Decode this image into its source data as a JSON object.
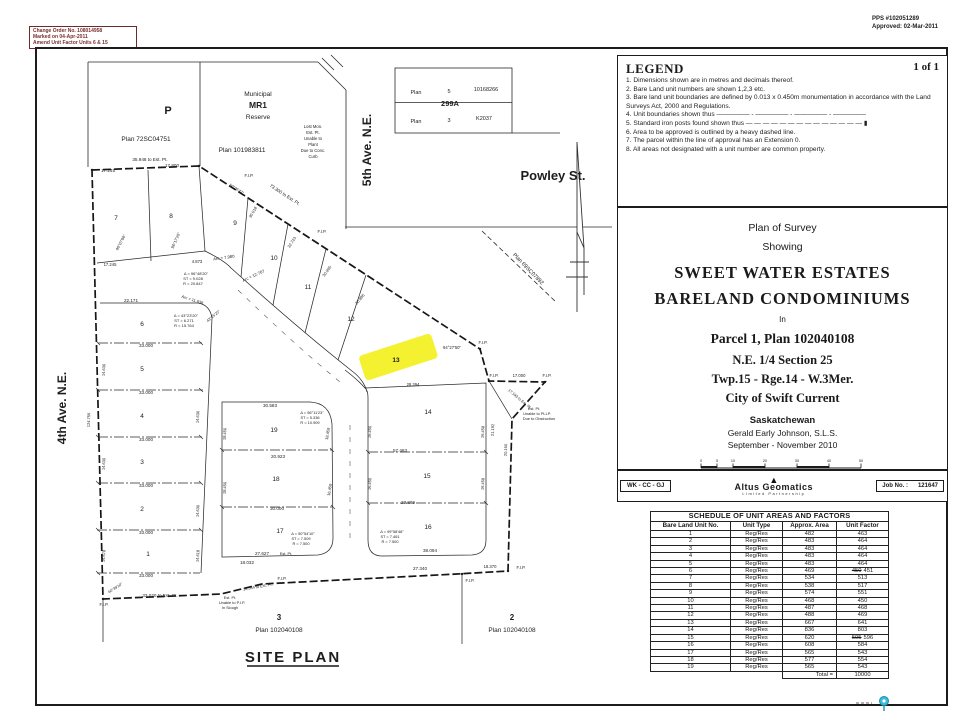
{
  "stamps": {
    "change_order": [
      "Change Order No. 108014958",
      "Marked on 04-Apr-2011",
      "Amend Unit Factor Units 6 & 15"
    ],
    "pps": "PPS #102051289",
    "approved": "Approved: 02-Mar-2011"
  },
  "legend": {
    "title": "LEGEND",
    "page": "1 of 1",
    "items": [
      "1. Dimensions shown are in metres and decimals thereof.",
      "2. Bare Land unit numbers are shown 1,2,3 etc.",
      "3. Bare land unit boundaries are defined by 0.013 x 0.450m monumentation in accordance with the Land Surveys Act, 2000 and Regulations.",
      "4. Unit boundaries shown thus ————— - ————— - ————— - —————",
      "5. Standard iron posts found shown thus — — — — — — — — — — — — — — ▮",
      "6. Area to be approved is outlined by a heavy dashed line.",
      "7. The parcel within the line of approval has an Extension 0.",
      "8. All areas not designated with a unit number are common property."
    ]
  },
  "title_block": {
    "line1": "Plan of Survey",
    "line2": "Showing",
    "name1": "SWEET WATER ESTATES",
    "name2": "BARELAND CONDOMINIUMS",
    "in_label": "In",
    "parcel": "Parcel 1, Plan 102040108",
    "quarter": "N.E. 1/4 Section 25",
    "township": "Twp.15 - Rge.14 - W.3Mer.",
    "city": "City of Swift Current",
    "province": "Saskatchewan",
    "surveyor": "Gerald Early Johnson, S.L.S.",
    "date_range": "September - November 2010",
    "scale_ticks": [
      "0",
      "5",
      "10",
      "20",
      "30",
      "40",
      "50"
    ],
    "scale_units": "metres",
    "scale_text": "Scale - 1 : 500",
    "crew": "WK - CC - GJ",
    "firm_name": "Altus Geomatics",
    "firm_sub": "Limited Partnership",
    "job_label": "Job No. :",
    "job_value": "121647"
  },
  "schedule": {
    "title": "SCHEDULE OF UNIT AREAS AND FACTORS",
    "columns": [
      "Bare Land Unit No.",
      "Unit Type",
      "Approx. Area",
      "Unit Factor"
    ],
    "rows": [
      [
        "1",
        "Reg/Res",
        "482",
        "463"
      ],
      [
        "2",
        "Reg/Res",
        "483",
        "464"
      ],
      [
        "3",
        "Reg/Res",
        "483",
        "464"
      ],
      [
        "4",
        "Reg/Res",
        "483",
        "464"
      ],
      [
        "5",
        "Reg/Res",
        "483",
        "464"
      ],
      [
        "6",
        "Reg/Res",
        "469",
        "450",
        "451"
      ],
      [
        "7",
        "Reg/Res",
        "534",
        "513"
      ],
      [
        "8",
        "Reg/Res",
        "538",
        "517"
      ],
      [
        "9",
        "Reg/Res",
        "574",
        "551"
      ],
      [
        "10",
        "Reg/Res",
        "468",
        "450"
      ],
      [
        "11",
        "Reg/Res",
        "487",
        "468"
      ],
      [
        "12",
        "Reg/Res",
        "488",
        "469"
      ],
      [
        "13",
        "Reg/Res",
        "667",
        "641"
      ],
      [
        "14",
        "Reg/Res",
        "836",
        "803"
      ],
      [
        "15",
        "Reg/Res",
        "620",
        "595",
        "596"
      ],
      [
        "16",
        "Reg/Res",
        "608",
        "584"
      ],
      [
        "17",
        "Reg/Res",
        "565",
        "543"
      ],
      [
        "18",
        "Reg/Res",
        "577",
        "554"
      ],
      [
        "19",
        "Reg/Res",
        "565",
        "543"
      ]
    ],
    "total_label": "Total =",
    "total_value": "10000"
  },
  "site_plan": {
    "title": "SITE PLAN",
    "highlight_color": "#f2ee0c",
    "lots": [
      {
        "t": "1",
        "x": 148,
        "y": 556
      },
      {
        "t": "2",
        "x": 142,
        "y": 511
      },
      {
        "t": "3",
        "x": 142,
        "y": 464
      },
      {
        "t": "4",
        "x": 142,
        "y": 418
      },
      {
        "t": "5",
        "x": 142,
        "y": 371
      },
      {
        "t": "6",
        "x": 142,
        "y": 326
      },
      {
        "t": "7",
        "x": 116,
        "y": 220
      },
      {
        "t": "8",
        "x": 171,
        "y": 218
      },
      {
        "t": "9",
        "x": 235,
        "y": 225
      },
      {
        "t": "10",
        "x": 274,
        "y": 260
      },
      {
        "t": "11",
        "x": 308,
        "y": 289
      },
      {
        "t": "12",
        "x": 351,
        "y": 321
      },
      {
        "t": "13",
        "x": 396,
        "y": 362,
        "b": 1
      },
      {
        "t": "14",
        "x": 428,
        "y": 414
      },
      {
        "t": "15",
        "x": 427,
        "y": 478
      },
      {
        "t": "16",
        "x": 428,
        "y": 529
      },
      {
        "t": "17",
        "x": 280,
        "y": 533
      },
      {
        "t": "18",
        "x": 276,
        "y": 481
      },
      {
        "t": "19",
        "x": 274,
        "y": 432
      }
    ],
    "annotations": [
      {
        "t": "4th Ave. N.E.",
        "x": 66,
        "y": 408,
        "r": -90,
        "s": 12,
        "b": 1,
        "f": 1,
        "n": "street-label-4th-ave"
      },
      {
        "t": "5th Ave. N.E.",
        "x": 371,
        "y": 150,
        "r": -90,
        "s": 12,
        "b": 1,
        "f": 1,
        "n": "street-label-5th-ave"
      },
      {
        "t": "Powley St.",
        "x": 553,
        "y": 180,
        "s": 13,
        "b": 1,
        "f": 1,
        "n": "street-label-powley"
      },
      {
        "t": "P",
        "x": 168,
        "y": 114,
        "s": 11,
        "b": 1,
        "f": 1,
        "n": "parcel-label-p"
      },
      {
        "t": "Plan 72SC04751",
        "x": 146,
        "y": 141,
        "s": 6.5,
        "n": "parcel-plan-number"
      },
      {
        "t": "Municipal",
        "x": 258,
        "y": 96,
        "s": 6.5,
        "n": "reserve-label"
      },
      {
        "t": "MR1",
        "x": 258,
        "y": 108,
        "s": 8.5,
        "b": 1,
        "n": "reserve-label"
      },
      {
        "t": "Reserve",
        "x": 258,
        "y": 119,
        "s": 6.5,
        "n": "reserve-label"
      },
      {
        "t": "Plan 101983811",
        "x": 242,
        "y": 152,
        "s": 6.5,
        "n": "parcel-plan-number"
      },
      {
        "t": "Plan 69SC07892",
        "x": 527,
        "y": 270,
        "r": 46,
        "s": 5.5,
        "n": "parcel-plan-number"
      },
      {
        "t": "Plan",
        "x": 416,
        "y": 94,
        "s": 5.5
      },
      {
        "t": "5",
        "x": 449,
        "y": 93,
        "s": 5.5
      },
      {
        "t": "10168266",
        "x": 486,
        "y": 91,
        "s": 5.5
      },
      {
        "t": "299A",
        "x": 450,
        "y": 106,
        "s": 7.5,
        "b": 1,
        "n": "plan-299a-label"
      },
      {
        "t": "Plan",
        "x": 416,
        "y": 123,
        "s": 5.5
      },
      {
        "t": "3",
        "x": 449,
        "y": 122,
        "s": 5.5
      },
      {
        "t": "K2037",
        "x": 484,
        "y": 120,
        "s": 5.5
      },
      {
        "t": "3",
        "x": 279,
        "y": 620,
        "s": 8,
        "b": 1,
        "n": "south-parcel-3"
      },
      {
        "t": "Plan 102040108",
        "x": 279,
        "y": 632,
        "s": 6.5,
        "n": "parcel-plan-number"
      },
      {
        "t": "2",
        "x": 512,
        "y": 620,
        "s": 8,
        "b": 1,
        "n": "south-parcel-2"
      },
      {
        "t": "Plan 102040108",
        "x": 512,
        "y": 632,
        "s": 6.5,
        "n": "parcel-plan-number"
      },
      {
        "t": "35.948 to Est. Pt.",
        "x": 150,
        "y": 161
      },
      {
        "t": "17.245",
        "x": 108,
        "y": 172
      },
      {
        "t": "17.800",
        "x": 172,
        "y": 167
      },
      {
        "t": "F.I.P.",
        "x": 249,
        "y": 177,
        "s": 4.2
      },
      {
        "t": "73.300 to Est. Pt.",
        "x": 284,
        "y": 196,
        "r": 33
      },
      {
        "t": "Lost Mon.",
        "x": 313,
        "y": 128,
        "s": 4.2
      },
      {
        "t": "Est. Pt.",
        "x": 313,
        "y": 134,
        "s": 4.2
      },
      {
        "t": "Unable to",
        "x": 313,
        "y": 140,
        "s": 4.2
      },
      {
        "t": "Plant",
        "x": 313,
        "y": 146,
        "s": 4.2
      },
      {
        "t": "Due to Conc.",
        "x": 313,
        "y": 152,
        "s": 4.2
      },
      {
        "t": "Curb",
        "x": 313,
        "y": 158,
        "s": 4.2
      },
      {
        "t": "90°07'00\"",
        "x": 122,
        "y": 243,
        "r": -62,
        "s": 4
      },
      {
        "t": "96°17'20\"",
        "x": 177,
        "y": 241,
        "r": -66,
        "s": 4
      },
      {
        "t": "17.245",
        "x": 110,
        "y": 266,
        "s": 4.2
      },
      {
        "t": "4.873",
        "x": 197,
        "y": 263,
        "s": 4.2
      },
      {
        "t": "Arc = 7.980",
        "x": 224,
        "y": 259,
        "r": -8,
        "s": 4.2
      },
      {
        "t": "Arc = 12.767",
        "x": 254,
        "y": 277,
        "r": -25,
        "s": 4.2
      },
      {
        "t": "Δ = 96°48'20\"",
        "x": 196,
        "y": 275,
        "s": 4
      },
      {
        "t": "ST = 9.028",
        "x": 193,
        "y": 280,
        "s": 4
      },
      {
        "t": "R = 20.847",
        "x": 193,
        "y": 285,
        "s": 4
      },
      {
        "t": "50°06'47\"",
        "x": 236,
        "y": 190,
        "r": 33,
        "s": 3.8
      },
      {
        "t": "30.018",
        "x": 254,
        "y": 213,
        "r": -60,
        "s": 4
      },
      {
        "t": "32.723",
        "x": 293,
        "y": 243,
        "r": -57,
        "s": 4
      },
      {
        "t": "30.995",
        "x": 328,
        "y": 272,
        "r": -54,
        "s": 4
      },
      {
        "t": "30.985",
        "x": 361,
        "y": 300,
        "r": -51,
        "s": 4
      },
      {
        "t": "F.I.P.",
        "x": 322,
        "y": 233,
        "s": 4.2
      },
      {
        "t": "F.I.P.",
        "x": 483,
        "y": 344,
        "s": 4.2
      },
      {
        "t": "94°27'50\"",
        "x": 452,
        "y": 349,
        "s": 4.2
      },
      {
        "t": "28.394",
        "x": 413,
        "y": 386,
        "s": 4.2
      },
      {
        "t": "17.000",
        "x": 519,
        "y": 377,
        "s": 4.2
      },
      {
        "t": "F.I.P.",
        "x": 494,
        "y": 377,
        "s": 4.2
      },
      {
        "t": "F.I.P.",
        "x": 547,
        "y": 377,
        "s": 4.2
      },
      {
        "t": "Est. Pt.",
        "x": 534,
        "y": 410,
        "s": 3.9
      },
      {
        "t": "Unable to PLLP.",
        "x": 537,
        "y": 415,
        "s": 3.9
      },
      {
        "t": "Due to Obstruction",
        "x": 539,
        "y": 420,
        "s": 3.9
      },
      {
        "t": "17.193 to Est. Pt.",
        "x": 519,
        "y": 400,
        "r": 40,
        "s": 3.8
      },
      {
        "t": "20.160",
        "x": 507,
        "y": 450,
        "r": -88,
        "s": 4
      },
      {
        "t": "21.192",
        "x": 494,
        "y": 430,
        "r": -88,
        "s": 4
      },
      {
        "t": "22.171",
        "x": 131,
        "y": 302
      },
      {
        "t": "33.000",
        "x": 146,
        "y": 347
      },
      {
        "t": "33.000",
        "x": 146,
        "y": 394
      },
      {
        "t": "33.000",
        "x": 146,
        "y": 441
      },
      {
        "t": "33.000",
        "x": 146,
        "y": 487
      },
      {
        "t": "33.000",
        "x": 146,
        "y": 534
      },
      {
        "t": "33.000",
        "x": 146,
        "y": 577
      },
      {
        "t": "14.630",
        "x": 105,
        "y": 370,
        "r": -86,
        "s": 4
      },
      {
        "t": "14.630",
        "x": 105,
        "y": 464,
        "r": -86,
        "s": 4
      },
      {
        "t": "14.678",
        "x": 105,
        "y": 556,
        "r": -86,
        "s": 4
      },
      {
        "t": "14.630",
        "x": 199,
        "y": 417,
        "r": -86,
        "s": 4
      },
      {
        "t": "14.630",
        "x": 199,
        "y": 511,
        "r": -86,
        "s": 4
      },
      {
        "t": "14.618",
        "x": 199,
        "y": 556,
        "r": -86,
        "s": 4
      },
      {
        "t": "124.756",
        "x": 90,
        "y": 420,
        "r": -88,
        "s": 4
      },
      {
        "t": "Δ = 43°23'20\"",
        "x": 186,
        "y": 317,
        "s": 4
      },
      {
        "t": "ST = 6.271",
        "x": 184,
        "y": 322,
        "s": 4
      },
      {
        "t": "R = 15.764",
        "x": 184,
        "y": 327,
        "s": 4
      },
      {
        "t": "Arc = 11.638",
        "x": 192,
        "y": 301,
        "r": 18,
        "s": 4
      },
      {
        "t": "43°25'20\"",
        "x": 214,
        "y": 317,
        "r": -40,
        "s": 3.8
      },
      {
        "t": "30.583",
        "x": 270,
        "y": 407
      },
      {
        "t": "20.923",
        "x": 278,
        "y": 458
      },
      {
        "t": "30.000",
        "x": 277,
        "y": 510
      },
      {
        "t": "27.627",
        "x": 262,
        "y": 555
      },
      {
        "t": "Est. Pt.",
        "x": 286,
        "y": 555,
        "s": 3.9
      },
      {
        "t": "18.032",
        "x": 247,
        "y": 564
      },
      {
        "t": "18.450",
        "x": 226,
        "y": 434,
        "r": -86,
        "s": 4
      },
      {
        "t": "18.450",
        "x": 226,
        "y": 488,
        "r": -86,
        "s": 4
      },
      {
        "t": "18.459",
        "x": 329,
        "y": 434,
        "r": -80,
        "s": 4
      },
      {
        "t": "16.459",
        "x": 331,
        "y": 490,
        "r": -80,
        "s": 4
      },
      {
        "t": "Δ = 56°11'23\"",
        "x": 312,
        "y": 414,
        "s": 3.9
      },
      {
        "t": "ST = 5.336",
        "x": 310,
        "y": 419,
        "s": 3.9
      },
      {
        "t": "R = 10.909",
        "x": 310,
        "y": 424,
        "s": 3.9
      },
      {
        "t": "Δ = 50°54'10\"",
        "x": 303,
        "y": 535,
        "s": 3.9
      },
      {
        "t": "ST = 7.509",
        "x": 301,
        "y": 540,
        "s": 3.9
      },
      {
        "t": "R = 7.500",
        "x": 301,
        "y": 545,
        "s": 3.9
      },
      {
        "t": "57.463",
        "x": 400,
        "y": 452
      },
      {
        "t": "27.889",
        "x": 408,
        "y": 504
      },
      {
        "t": "38.094",
        "x": 430,
        "y": 552
      },
      {
        "t": "16.450",
        "x": 371,
        "y": 432,
        "r": -86,
        "s": 4
      },
      {
        "t": "16.450",
        "x": 371,
        "y": 484,
        "r": -86,
        "s": 4
      },
      {
        "t": "16.458",
        "x": 484,
        "y": 432,
        "r": -86,
        "s": 4
      },
      {
        "t": "16.458",
        "x": 484,
        "y": 484,
        "r": -86,
        "s": 4
      },
      {
        "t": "Δ = 99°58'48\"",
        "x": 392,
        "y": 533,
        "s": 3.9
      },
      {
        "t": "ST = 7.461",
        "x": 390,
        "y": 538,
        "s": 3.9
      },
      {
        "t": "R = 7.500",
        "x": 390,
        "y": 543,
        "s": 3.9
      },
      {
        "t": "F.I.P.",
        "x": 104,
        "y": 606,
        "s": 4.2
      },
      {
        "t": "33.020 to Est. Pt.",
        "x": 160,
        "y": 597
      },
      {
        "t": "60°39'10\"",
        "x": 116,
        "y": 589,
        "r": -33,
        "s": 3.8
      },
      {
        "t": "Est. Pt.",
        "x": 230,
        "y": 599,
        "s": 3.9
      },
      {
        "t": "Unable to P.I.P.",
        "x": 232,
        "y": 604,
        "s": 3.9
      },
      {
        "t": "In Slough",
        "x": 230,
        "y": 609,
        "s": 3.9
      },
      {
        "t": "16.554 to Est. Pt.",
        "x": 258,
        "y": 588,
        "r": -10,
        "s": 3.9
      },
      {
        "t": "F.I.P.",
        "x": 282,
        "y": 580,
        "s": 4.2
      },
      {
        "t": "27.340",
        "x": 420,
        "y": 570
      },
      {
        "t": "F.I.P.",
        "x": 470,
        "y": 582,
        "s": 4.2
      },
      {
        "t": "18.370",
        "x": 490,
        "y": 568,
        "s": 4.2
      },
      {
        "t": "F.I.P.",
        "x": 521,
        "y": 569,
        "s": 4.2
      }
    ]
  }
}
